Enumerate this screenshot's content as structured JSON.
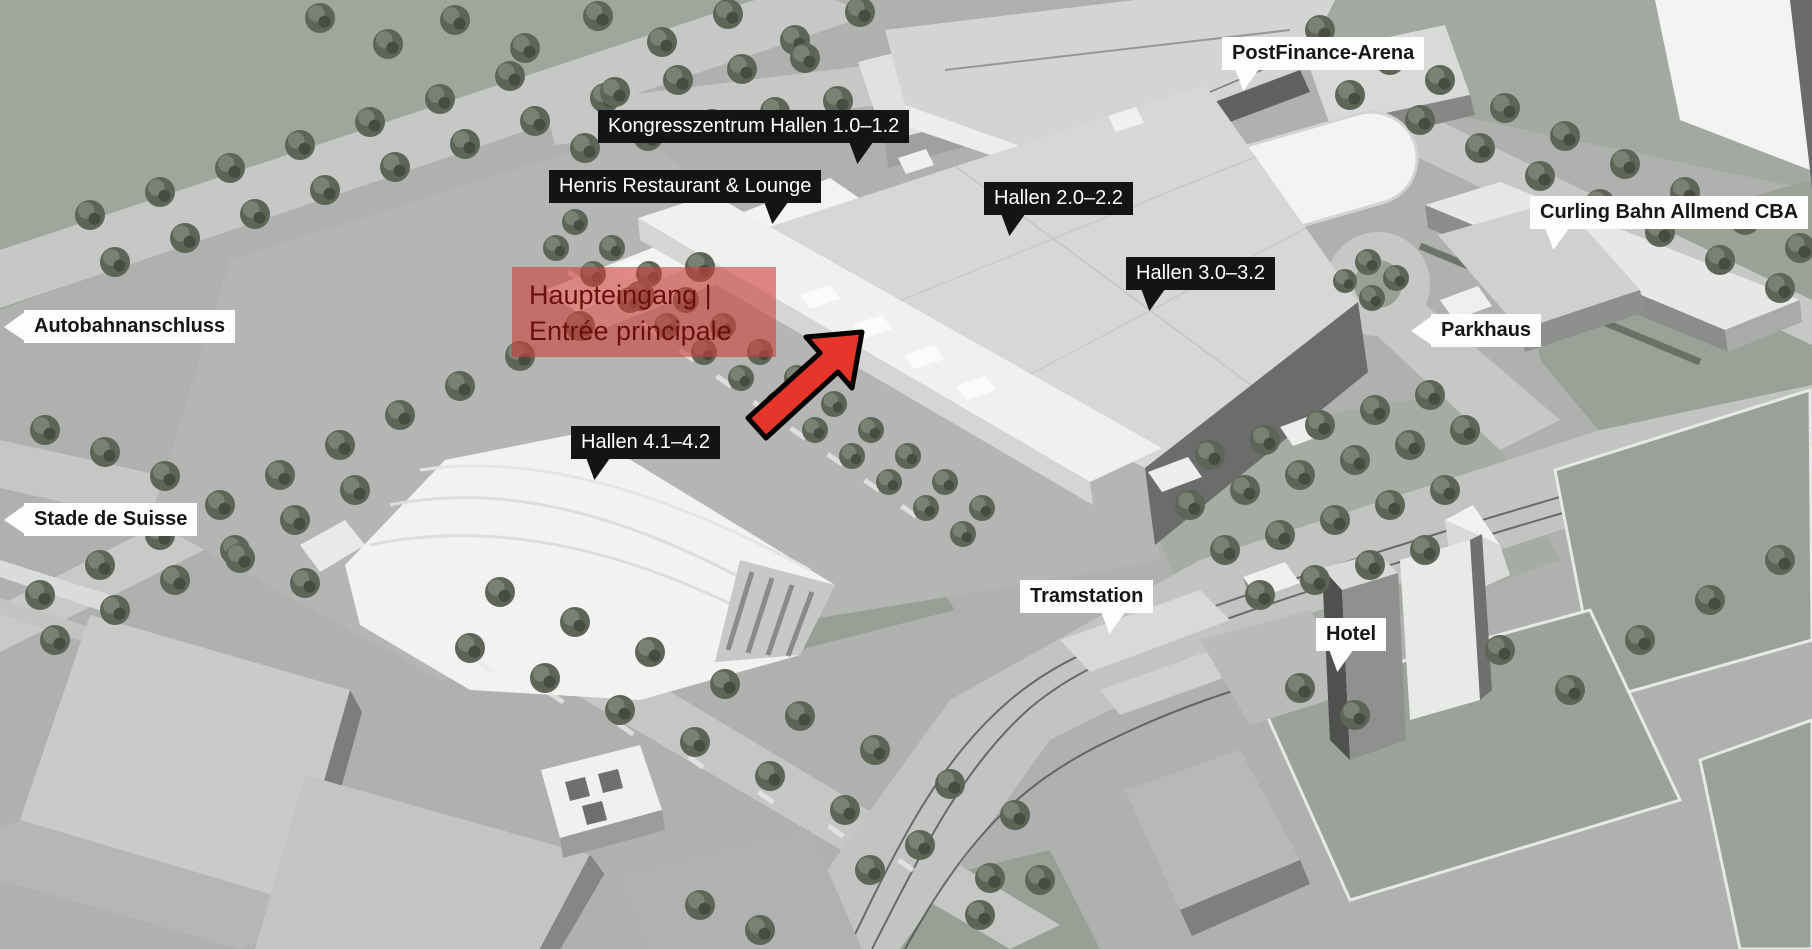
{
  "map": {
    "background_color": "#afb1ae",
    "accent_red": "#e6352b",
    "entrance_highlight": {
      "line1": "Haupteingang |",
      "line2": "Entrée principale",
      "bg": "rgba(206,62,57,0.6)",
      "text_color": "#69120d"
    },
    "labels": {
      "kongresszentrum": {
        "text": "Kongresszentrum Hallen 1.0–1.2",
        "style": "dark"
      },
      "henris": {
        "text": "Henris Restaurant & Lounge",
        "style": "dark"
      },
      "postfinance": {
        "text": "PostFinance-Arena",
        "style": "light"
      },
      "hallen22": {
        "text": "Hallen 2.0–2.2",
        "style": "dark"
      },
      "hallen32": {
        "text": "Hallen 3.0–3.2",
        "style": "dark"
      },
      "curling": {
        "text": "Curling Bahn Allmend CBA",
        "style": "light"
      },
      "parkhaus": {
        "text": "Parkhaus",
        "style": "light"
      },
      "autobahn": {
        "text": "Autobahnanschluss",
        "style": "light"
      },
      "stade": {
        "text": "Stade de Suisse",
        "style": "light"
      },
      "hallen41": {
        "text": "Hallen 4.1–4.2",
        "style": "dark"
      },
      "tramstation": {
        "text": "Tramstation",
        "style": "light"
      },
      "hotel": {
        "text": "Hotel",
        "style": "light"
      }
    },
    "label_colors": {
      "dark_bg": "#141414",
      "dark_text": "#ffffff",
      "light_bg": "#fdfdfd",
      "light_text": "#161616"
    }
  }
}
